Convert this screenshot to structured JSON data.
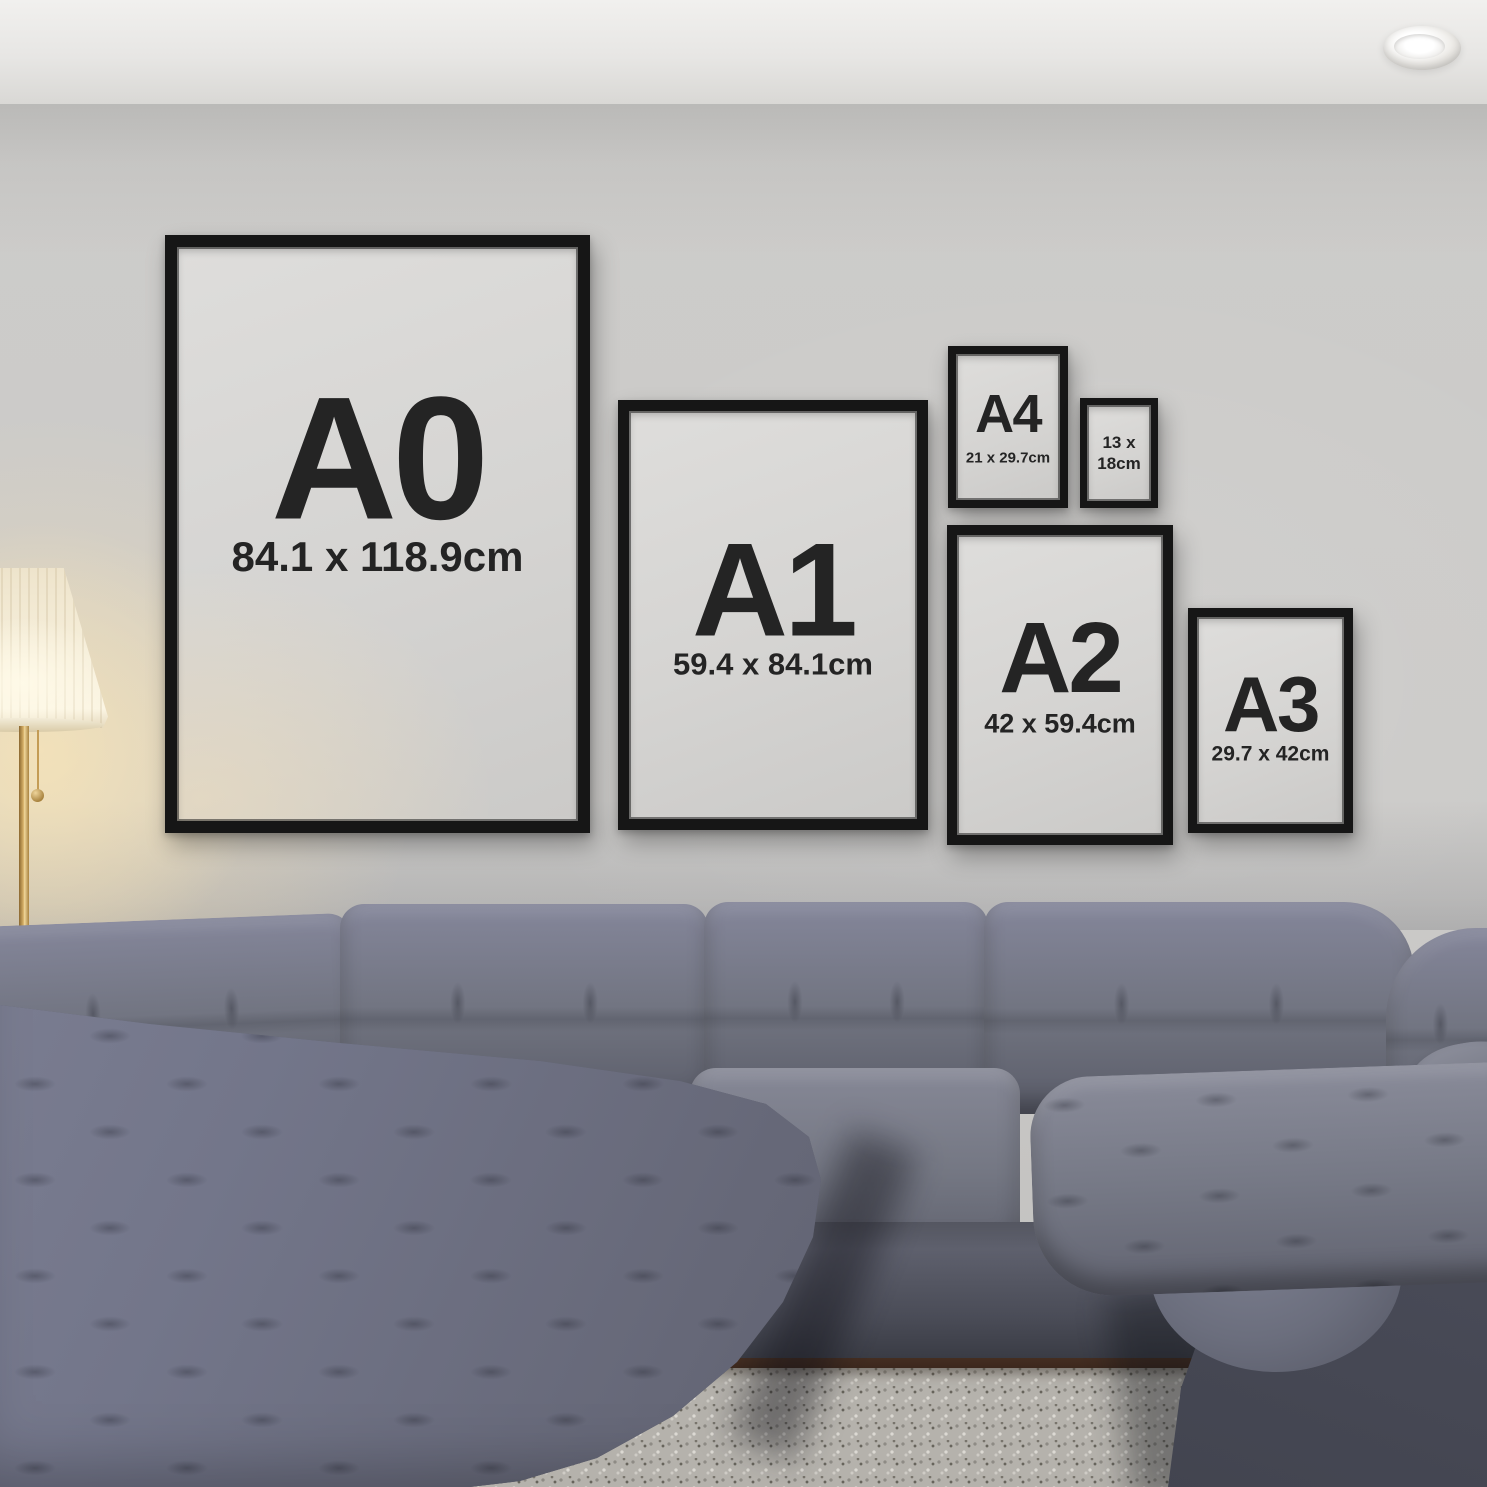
{
  "scene": {
    "description": "Living room wall with six black poster frames showing standard print sizes above a grey tufted sectional sofa, floor lamp on the left, shaggy rug below",
    "colors": {
      "wall": "#cbcac8",
      "ceiling": "#f1f0ee",
      "frame_black": "#161616",
      "frame_mat": "#d5d4d2",
      "label_text": "#242424",
      "sofa": "#70737f",
      "rug": "#b5b2ac",
      "floor_wood": "#3c281d",
      "lamp_glow": "#fce2ac",
      "lamp_pole_brass": "#c9a45e"
    }
  },
  "frames": [
    {
      "label": "A0",
      "size": "84.1 x 118.9cm"
    },
    {
      "label": "A1",
      "size": "59.4 x 84.1cm"
    },
    {
      "label": "A4",
      "size": "21 x 29.7cm"
    },
    {
      "lines": [
        "13 x",
        "18cm"
      ]
    },
    {
      "label": "A2",
      "size": "42 x 59.4cm"
    },
    {
      "label": "A3",
      "size": "29.7 x 42cm"
    }
  ]
}
